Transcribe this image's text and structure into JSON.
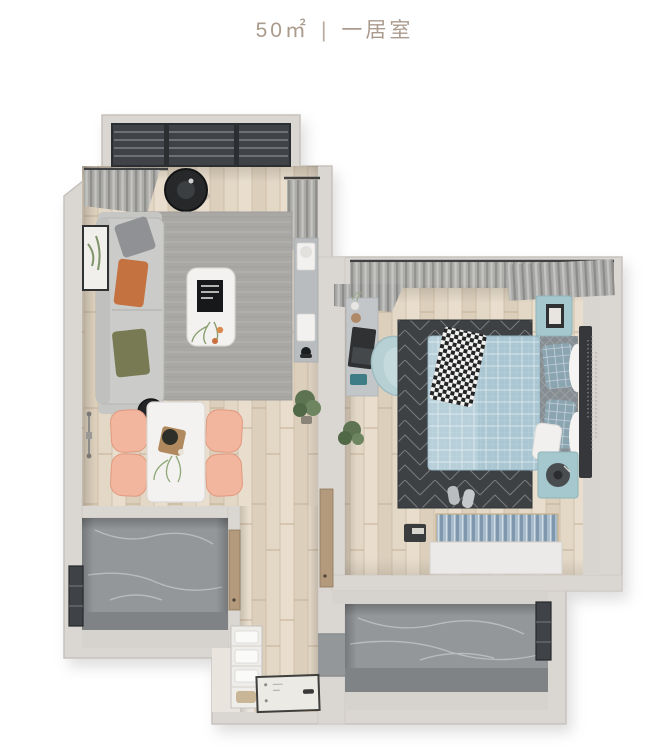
{
  "title": {
    "area": "50㎡",
    "separator": "|",
    "type": "一居室"
  },
  "colors": {
    "background": "#ffffff",
    "title_text": "#ab9b8d",
    "wall": "#dad6d2",
    "wall_edge": "#c6c1bc",
    "wall_face": "#d8d4d0",
    "wood": "#e3d7c6",
    "marble": "#94979a",
    "marble_dark": "#808386",
    "entry_floor": "#e9e4de",
    "rug_living": "#a9a8a5",
    "rug_bedroom": "#3e4144",
    "sofa": "#cbcbc9",
    "pillow_orange": "#c4723f",
    "pillow_olive": "#777a52",
    "pillow_gray": "#8f9194",
    "chair_peach": "#f2b59d",
    "furniture_white": "#f3f2f0",
    "console_gray": "#b9bcbe",
    "duvet_blue": "#a9c6d2",
    "quilt_gray": "#878e93",
    "pillow_blue": "#8aa4b0",
    "headboard": "#35373a",
    "nightstand_teal": "#a4c8cd",
    "curtain": "#a9a9a7",
    "window_dark": "#3f4246",
    "door_wood": "#b49a7c",
    "plant": "#5d7352",
    "entry_mat": "#eceae4",
    "records_blue": "#a9bccb"
  },
  "plan": {
    "rooms": [
      {
        "name": "living-room",
        "furniture": [
          "balcony-window",
          "curtains",
          "robot-vacuum",
          "sofa",
          "throw-pillows",
          "wall-art",
          "side-tables",
          "area-rug",
          "coffee-table",
          "media-console",
          "speakers",
          "plant"
        ]
      },
      {
        "name": "dining-area",
        "furniture": [
          "dining-table",
          "dining-chairs",
          "wall-sconce",
          "centerpiece"
        ]
      },
      {
        "name": "kitchen",
        "furniture": [
          "window",
          "door"
        ]
      },
      {
        "name": "bedroom",
        "furniture": [
          "curtains",
          "desk",
          "laptop",
          "desk-chair",
          "area-rug",
          "double-bed",
          "pillows",
          "throw-blanket",
          "nightstands",
          "picture-frame",
          "record-player",
          "storage-chest",
          "slippers",
          "plant",
          "wall-decal"
        ]
      },
      {
        "name": "bathroom",
        "furniture": [
          "window",
          "doorway"
        ]
      },
      {
        "name": "hallway",
        "furniture": [
          "storage-shelf",
          "towels",
          "entrance-door",
          "plant"
        ]
      }
    ]
  }
}
